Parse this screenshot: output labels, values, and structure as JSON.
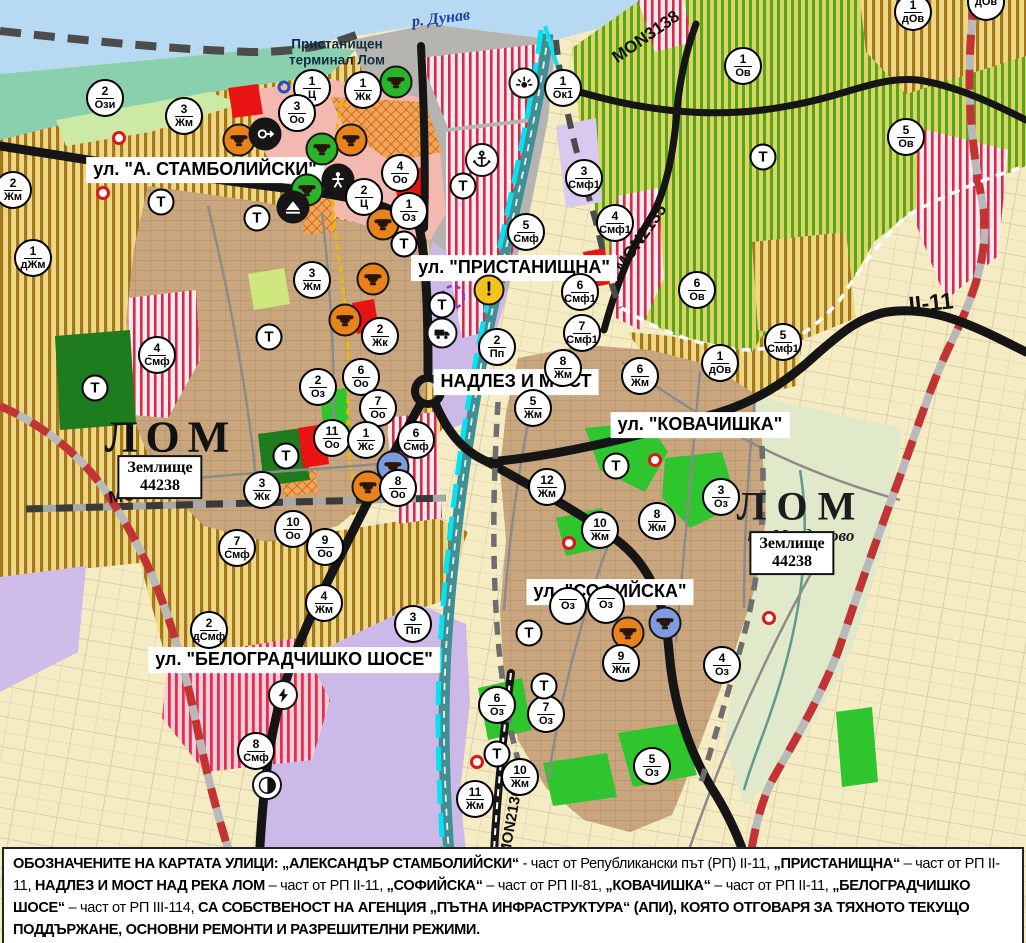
{
  "map_title": "Общ устройствен план - гр. Лом",
  "colors": {
    "water": "#b7d9f2",
    "shore": "#8ad0ae",
    "port_gray": "#b6b4b1",
    "vineyard_green": "#d9d466",
    "vineyard_stripe": "#58a51c",
    "villa_yellow": "#eed886",
    "villa_stripe": "#a3771a",
    "smf_red_stripe": "#d62a4a",
    "town_brown": "#c9a67e",
    "center_pink": "#f3b9b0",
    "production_purple": "#ccb9e8",
    "park_green": "#2fc52f",
    "forest_green": "#1e7b1e",
    "red_zone": "#e81414",
    "river_cyan": "#06e2f2",
    "railway_red": "#c23333",
    "road_black": "#151515",
    "cream": "#f6ecc3",
    "monument_orange": "#e8821a",
    "monument_green": "#2ab42a",
    "monument_blue": "#7f9be0",
    "warning_yellow": "#f2c31c"
  },
  "t_label": "Т",
  "street_signs": [
    {
      "text": "ул. \"А. СТАМБОЛИЙСКИ\"",
      "x": 205,
      "y": 170
    },
    {
      "text": "ул. \"ПРИСТАНИЩНА\"",
      "x": 514,
      "y": 268
    },
    {
      "text": "НАДЛЕЗ И МОСТ",
      "x": 516,
      "y": 382
    },
    {
      "text": "ул. \"КОВАЧИШКА\"",
      "x": 700,
      "y": 425
    },
    {
      "text": "ул. \"СОФИЙСКА\"",
      "x": 610,
      "y": 592
    },
    {
      "text": "ул. \"БЕЛОГРАДЧИШКО ШОСЕ\"",
      "x": 294,
      "y": 660
    }
  ],
  "area_labels": [
    {
      "text": "р. Дунав",
      "x": 441,
      "y": 19,
      "size": 16,
      "color": "#1c3fa0",
      "rotate": -7,
      "serif": true,
      "italic": true
    },
    {
      "text": "Пристанищен",
      "x": 337,
      "y": 44,
      "size": 13.5,
      "color": "#102a43"
    },
    {
      "text": "терминал Лом",
      "x": 337,
      "y": 60,
      "size": 13.5,
      "color": "#102a43"
    },
    {
      "text": "ЛОМ",
      "x": 171,
      "y": 437,
      "size": 44,
      "serif": true,
      "ls": 8
    },
    {
      "text": "MON3139",
      "x": 147,
      "y": 493,
      "size": 17,
      "rotate": -8
    },
    {
      "text": "ЛОМ",
      "x": 801,
      "y": 506,
      "size": 40,
      "serif": true,
      "ls": 10,
      "color": "#1c1c1c"
    },
    {
      "text": "кв. Младеново",
      "x": 801,
      "y": 536,
      "size": 17,
      "serif": true,
      "italic": true,
      "color": "#1c1c1c"
    },
    {
      "text": "MON3138",
      "x": 646,
      "y": 37,
      "size": 17,
      "rotate": -35
    },
    {
      "text": "MON2135",
      "x": 641,
      "y": 238,
      "size": 17,
      "rotate": -55
    },
    {
      "text": "MON2136",
      "x": 511,
      "y": 822,
      "size": 15,
      "rotate": -80
    },
    {
      "text": "II-11",
      "x": 931,
      "y": 303,
      "size": 23,
      "rotate": -6
    }
  ],
  "land_boxes": [
    {
      "l1": "Землище",
      "l2": "44238",
      "x": 160,
      "y": 477
    },
    {
      "l1": "Землище",
      "l2": "44238",
      "x": 792,
      "y": 553
    }
  ],
  "zone_markers": [
    {
      "x": 105,
      "y": 98,
      "n": "2",
      "c": "Ози"
    },
    {
      "x": 312,
      "y": 88,
      "n": "1",
      "c": "Ц"
    },
    {
      "x": 297,
      "y": 113,
      "n": "3",
      "c": "Оо"
    },
    {
      "x": 363,
      "y": 90,
      "n": "1",
      "c": "Жк"
    },
    {
      "x": 184,
      "y": 116,
      "n": "3",
      "c": "Жм"
    },
    {
      "x": 13,
      "y": 190,
      "n": "2",
      "c": "Жм"
    },
    {
      "x": 33,
      "y": 258,
      "n": "1",
      "c": "дЖм"
    },
    {
      "x": 400,
      "y": 173,
      "n": "4",
      "c": "Оо"
    },
    {
      "x": 364,
      "y": 197,
      "n": "2",
      "c": "Ц"
    },
    {
      "x": 409,
      "y": 211,
      "n": "1",
      "c": "Оз"
    },
    {
      "x": 563,
      "y": 88,
      "n": "1",
      "c": "Ок1"
    },
    {
      "x": 584,
      "y": 178,
      "n": "3",
      "c": "Смф1"
    },
    {
      "x": 526,
      "y": 232,
      "n": "5",
      "c": "Смф"
    },
    {
      "x": 615,
      "y": 223,
      "n": "4",
      "c": "Смф1"
    },
    {
      "x": 580,
      "y": 292,
      "n": "6",
      "c": "Смф1"
    },
    {
      "x": 582,
      "y": 333,
      "n": "7",
      "c": "Смф1"
    },
    {
      "x": 697,
      "y": 290,
      "n": "6",
      "c": "Ов"
    },
    {
      "x": 783,
      "y": 342,
      "n": "5",
      "c": "Смф1"
    },
    {
      "x": 720,
      "y": 363,
      "n": "1",
      "c": "дОв"
    },
    {
      "x": 906,
      "y": 137,
      "n": "5",
      "c": "Ов"
    },
    {
      "x": 743,
      "y": 66,
      "n": "1",
      "c": "Ов"
    },
    {
      "x": 913,
      "y": 12,
      "n": "1",
      "c": "дОв"
    },
    {
      "x": 986,
      "y": 2,
      "n": "",
      "c": "дОв",
      "u": 1
    },
    {
      "x": 497,
      "y": 347,
      "n": "2",
      "c": "Пп"
    },
    {
      "x": 563,
      "y": 368,
      "n": "8",
      "c": "Жм"
    },
    {
      "x": 533,
      "y": 408,
      "n": "5",
      "c": "Жм"
    },
    {
      "x": 640,
      "y": 376,
      "n": "6",
      "c": "Жм"
    },
    {
      "x": 312,
      "y": 280,
      "n": "3",
      "c": "Жм"
    },
    {
      "x": 547,
      "y": 487,
      "n": "12",
      "c": "Жм"
    },
    {
      "x": 600,
      "y": 530,
      "n": "10",
      "c": "Жм"
    },
    {
      "x": 657,
      "y": 521,
      "n": "8",
      "c": "Жм"
    },
    {
      "x": 721,
      "y": 497,
      "n": "3",
      "c": "Оз"
    },
    {
      "x": 621,
      "y": 663,
      "n": "9",
      "c": "Жм"
    },
    {
      "x": 722,
      "y": 665,
      "n": "4",
      "c": "Оз"
    },
    {
      "x": 318,
      "y": 387,
      "n": "2",
      "c": "Оз"
    },
    {
      "x": 380,
      "y": 336,
      "n": "2",
      "c": "Жк"
    },
    {
      "x": 361,
      "y": 377,
      "n": "6",
      "c": "Оо"
    },
    {
      "x": 378,
      "y": 408,
      "n": "7",
      "c": "Оо"
    },
    {
      "x": 332,
      "y": 438,
      "n": "11",
      "c": "Оо"
    },
    {
      "x": 366,
      "y": 440,
      "n": "1",
      "c": "Жс"
    },
    {
      "x": 416,
      "y": 440,
      "n": "6",
      "c": "Смф"
    },
    {
      "x": 398,
      "y": 488,
      "n": "8",
      "c": "Оо"
    },
    {
      "x": 262,
      "y": 490,
      "n": "3",
      "c": "Жк"
    },
    {
      "x": 293,
      "y": 529,
      "n": "10",
      "c": "Оо"
    },
    {
      "x": 325,
      "y": 547,
      "n": "9",
      "c": "Оо"
    },
    {
      "x": 237,
      "y": 548,
      "n": "7",
      "c": "Смф"
    },
    {
      "x": 157,
      "y": 355,
      "n": "4",
      "c": "Смф"
    },
    {
      "x": 209,
      "y": 630,
      "n": "2",
      "c": "дСмф"
    },
    {
      "x": 324,
      "y": 603,
      "n": "4",
      "c": "Жм"
    },
    {
      "x": 413,
      "y": 624,
      "n": "3",
      "c": "Пп"
    },
    {
      "x": 256,
      "y": 751,
      "n": "8",
      "c": "Смф"
    },
    {
      "x": 497,
      "y": 705,
      "n": "6",
      "c": "Оз"
    },
    {
      "x": 546,
      "y": 714,
      "n": "7",
      "c": "Оз"
    },
    {
      "x": 520,
      "y": 777,
      "n": "10",
      "c": "Жм"
    },
    {
      "x": 475,
      "y": 799,
      "n": "11",
      "c": "Жм"
    },
    {
      "x": 652,
      "y": 766,
      "n": "5",
      "c": "Оз"
    },
    {
      "x": 568,
      "y": 606,
      "n": "",
      "c": "Оз",
      "u": 1
    },
    {
      "x": 606,
      "y": 605,
      "n": "",
      "c": "Оз",
      "u": 1
    }
  ],
  "t_markers": [
    [
      161,
      202
    ],
    [
      257,
      218
    ],
    [
      269,
      337
    ],
    [
      95,
      388
    ],
    [
      286,
      456
    ],
    [
      463,
      186
    ],
    [
      404,
      244
    ],
    [
      442,
      305
    ],
    [
      763,
      157
    ],
    [
      616,
      466
    ],
    [
      529,
      633
    ],
    [
      544,
      686
    ],
    [
      497,
      754
    ]
  ],
  "poi_icons": [
    {
      "type": "monument",
      "color": "orange",
      "x": 239,
      "y": 140
    },
    {
      "type": "monument",
      "color": "orange",
      "x": 351,
      "y": 140
    },
    {
      "type": "monument",
      "color": "green",
      "x": 396,
      "y": 82
    },
    {
      "type": "monument",
      "color": "green",
      "x": 322,
      "y": 149
    },
    {
      "type": "monument",
      "color": "green",
      "x": 307,
      "y": 190
    },
    {
      "type": "monument",
      "color": "orange",
      "x": 383,
      "y": 224
    },
    {
      "type": "monument",
      "color": "orange",
      "x": 373,
      "y": 279
    },
    {
      "type": "monument",
      "color": "orange",
      "x": 345,
      "y": 320
    },
    {
      "type": "monument",
      "color": "orange",
      "x": 368,
      "y": 487
    },
    {
      "type": "monument",
      "color": "blue",
      "x": 393,
      "y": 467
    },
    {
      "type": "monument",
      "color": "orange",
      "x": 628,
      "y": 633
    },
    {
      "type": "monument",
      "color": "blue",
      "x": 665,
      "y": 623
    },
    {
      "type": "circle-arrow",
      "x": 265,
      "y": 134
    },
    {
      "type": "person",
      "x": 338,
      "y": 180
    },
    {
      "type": "mound",
      "x": 293,
      "y": 207
    },
    {
      "type": "anchor",
      "x": 482,
      "y": 160
    },
    {
      "type": "sun",
      "x": 524,
      "y": 83
    },
    {
      "type": "warning",
      "x": 489,
      "y": 290,
      "glyph": "!"
    },
    {
      "type": "truck",
      "x": 442,
      "y": 333
    },
    {
      "type": "bolt",
      "x": 283,
      "y": 695
    },
    {
      "type": "crossing",
      "x": 267,
      "y": 785
    }
  ],
  "dot_markers": [
    {
      "t": "blue",
      "x": 284,
      "y": 87
    },
    {
      "t": "red",
      "x": 119,
      "y": 138
    },
    {
      "t": "red",
      "x": 103,
      "y": 193
    },
    {
      "t": "red",
      "x": 655,
      "y": 460
    },
    {
      "t": "red",
      "x": 569,
      "y": 543
    },
    {
      "t": "red",
      "x": 477,
      "y": 762
    },
    {
      "t": "red",
      "x": 769,
      "y": 618
    }
  ],
  "note": {
    "segments": [
      {
        "t": "ОБОЗНАЧЕНИТЕ НА КАРТАТА УЛИЦИ: „АЛЕКСАНДЪР СТАМБОЛИЙСКИ“",
        "b": true
      },
      {
        "t": " - част от Републикански път (РП) II-11, ",
        "b": false
      },
      {
        "t": "„ПРИСТАНИЩНА“",
        "b": true
      },
      {
        "t": " – част от РП II-11, ",
        "b": false
      },
      {
        "t": "НАДЛЕЗ И МОСТ НАД РЕКА ЛОМ",
        "b": true
      },
      {
        "t": " – част от РП II-11, ",
        "b": false
      },
      {
        "t": "„СОФИЙСКА“",
        "b": true
      },
      {
        "t": " – част от РП II-81, ",
        "b": false
      },
      {
        "t": "„КОВАЧИШКА“",
        "b": true
      },
      {
        "t": " – част от РП II-11, ",
        "b": false
      },
      {
        "t": "„БЕЛОГРАДЧИШКО ШОСЕ“",
        "b": true
      },
      {
        "t": " – част от РП III-114, ",
        "b": false
      },
      {
        "t": "СА СОБСТВЕНОСТ НА АГЕНЦИЯ „ПЪТНА ИНФРАСТРУКТУРА“ (АПИ), КОЯТО ОТГОВАРЯ ЗА ТЯХНОТО ТЕКУЩО ПОДДЪРЖАНЕ, ОСНОВНИ РЕМОНТИ И РАЗРЕШИТЕЛНИ РЕЖИМИ.",
        "b": true
      }
    ]
  }
}
